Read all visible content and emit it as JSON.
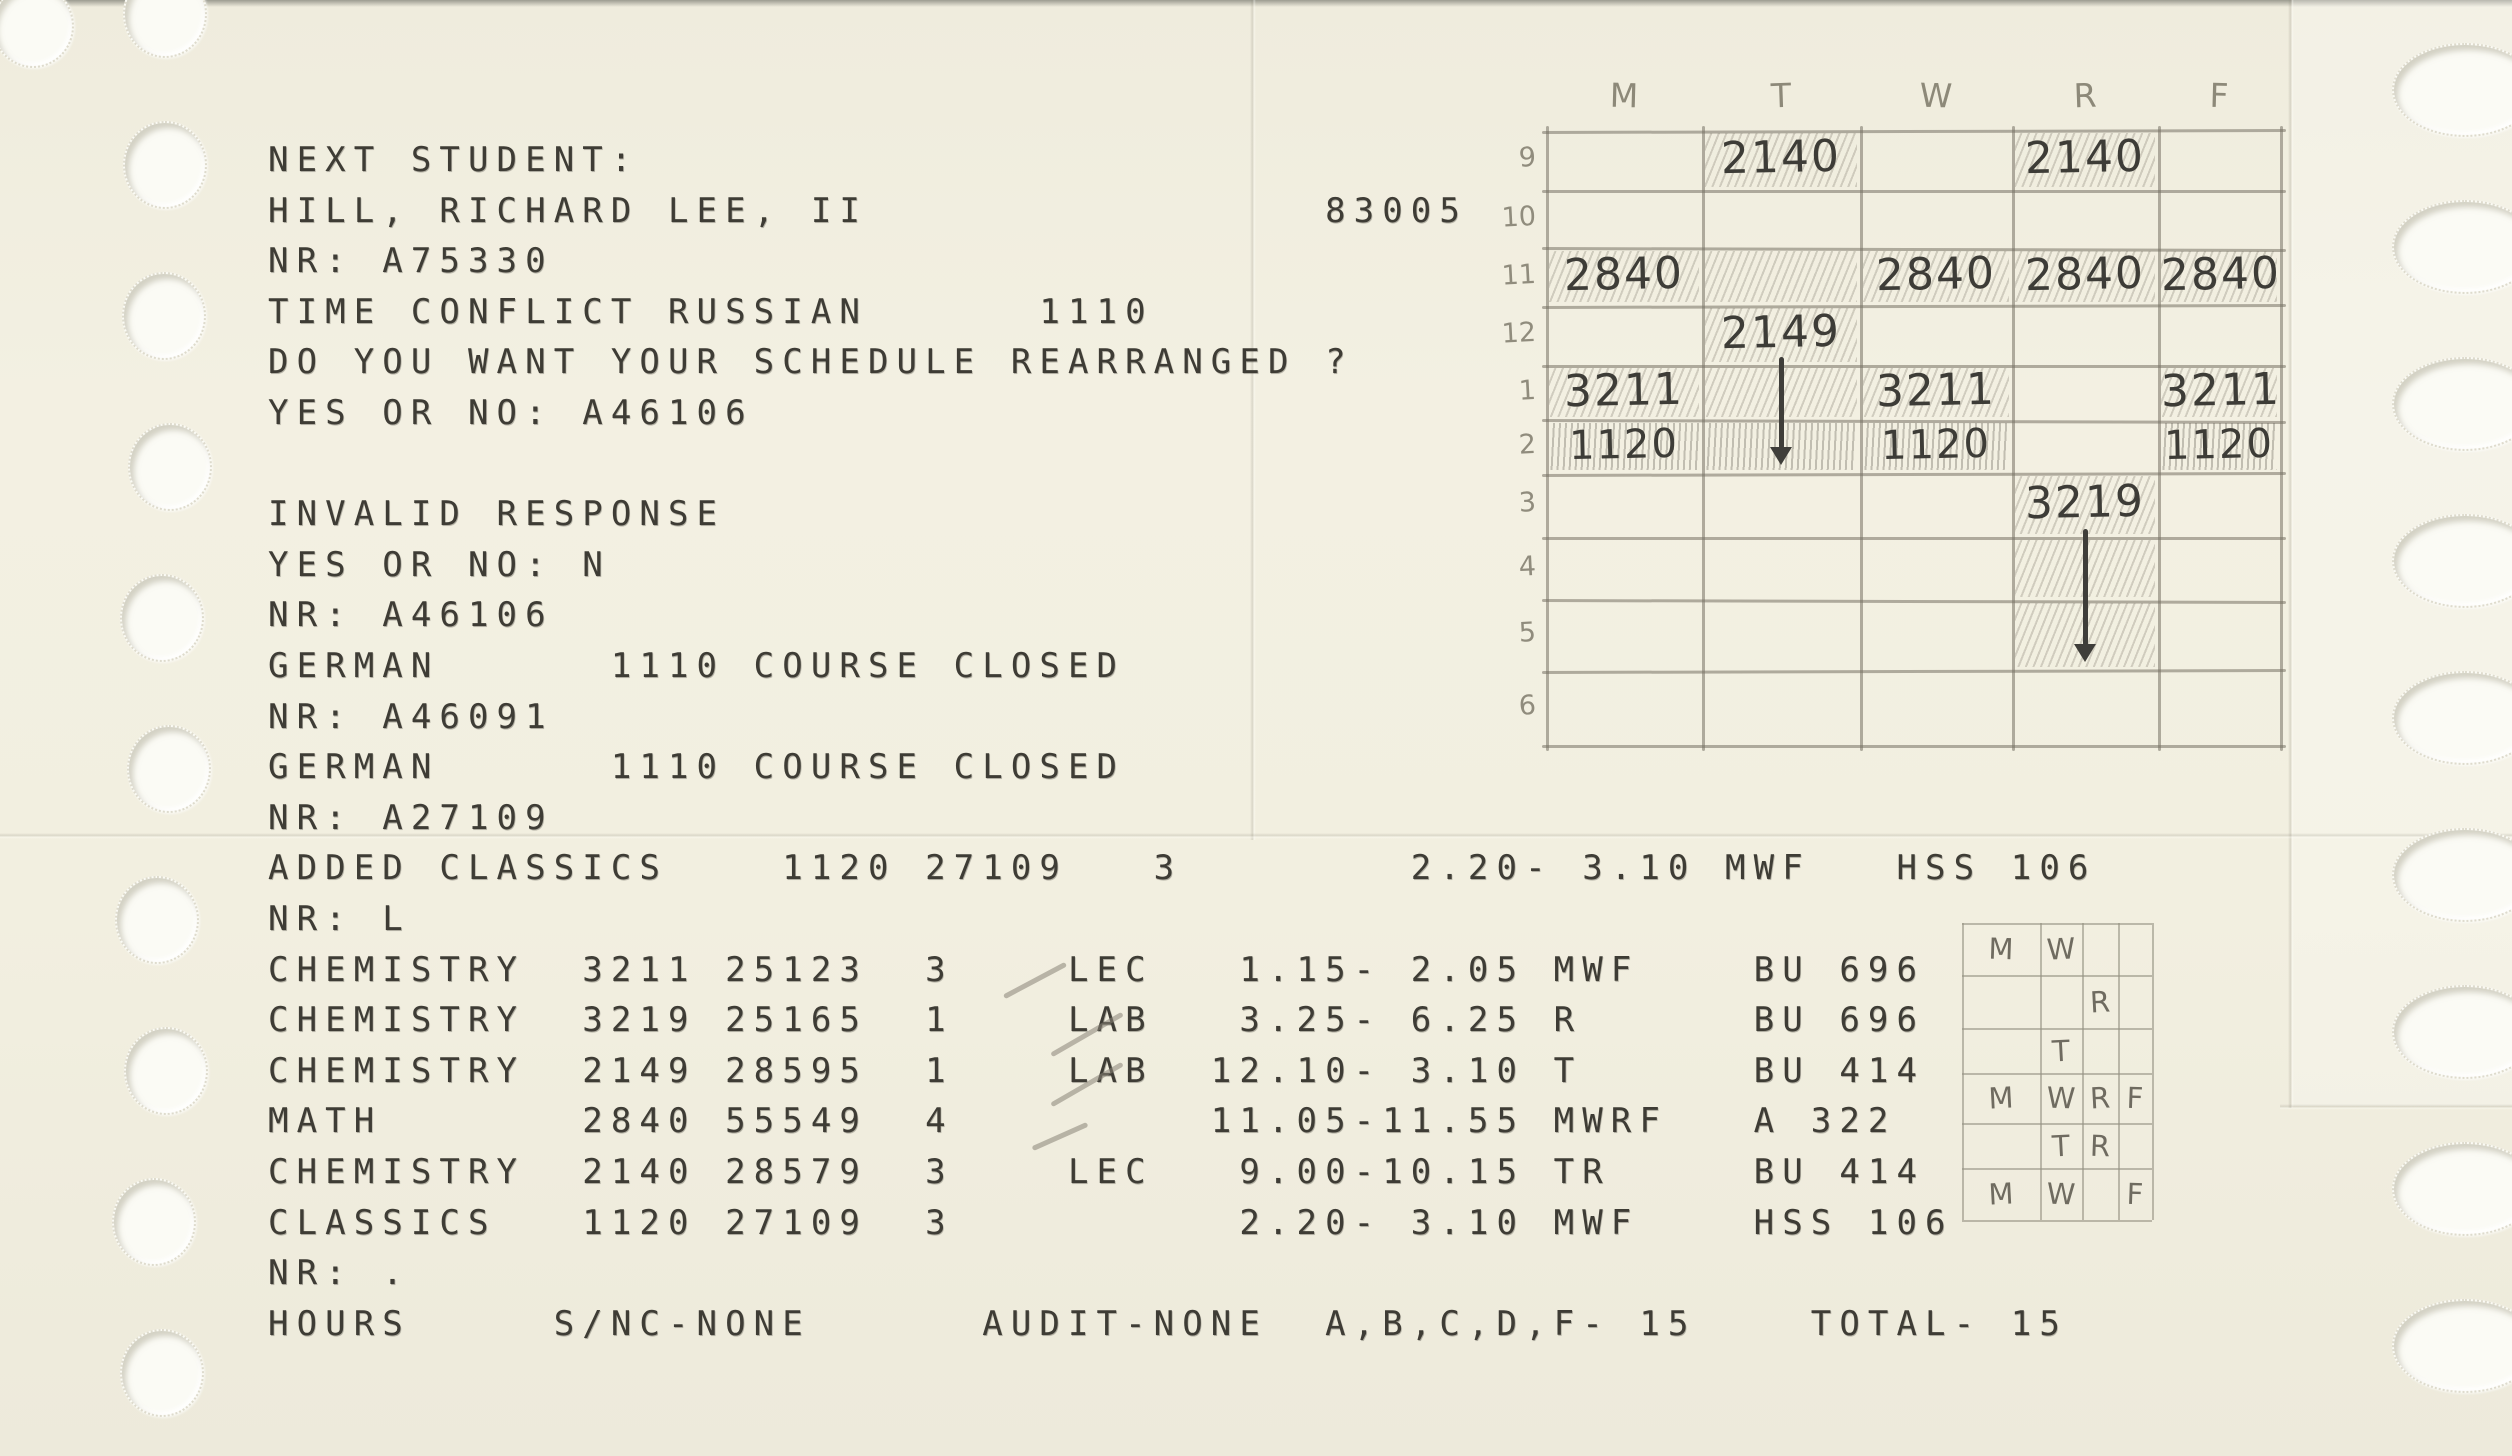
{
  "printout": {
    "lines": [
      "NEXT STUDENT:",
      "HILL, RICHARD LEE, II                83005",
      "NR: A75330",
      "TIME CONFLICT RUSSIAN      1110",
      "DO YOU WANT YOUR SCHEDULE REARRANGED ?",
      "YES OR NO: A46106",
      "",
      "INVALID RESPONSE",
      "YES OR NO: N",
      "NR: A46106",
      "GERMAN      1110 COURSE CLOSED",
      "NR: A46091",
      "GERMAN      1110 COURSE CLOSED",
      "NR: A27109",
      "ADDED CLASSICS    1120 27109   3        2.20- 3.10 MWF   HSS 106",
      "NR: L",
      "CHEMISTRY  3211 25123  3    LEC   1.15- 2.05 MWF    BU 696",
      "CHEMISTRY  3219 25165  1    LAB   3.25- 6.25 R      BU 696",
      "CHEMISTRY  2149 28595  1    LAB  12.10- 3.10 T      BU 414",
      "MATH       2840 55549  4         11.05-11.55 MWRF   A 322",
      "CHEMISTRY  2140 28579  3    LEC   9.00-10.15 TR     BU 414",
      "CLASSICS   1120 27109  3          2.20- 3.10 MWF    HSS 106",
      "NR: .",
      "HOURS     S/NC-NONE      AUDIT-NONE  A,B,C,D,F- 15    TOTAL- 15"
    ],
    "student_name": "HILL, RICHARD LEE, II",
    "student_nr_prompts": [
      "A75330",
      "A46106",
      "A46091",
      "A27109",
      "L",
      "."
    ],
    "terminal_number": "83005",
    "courses": [
      {
        "dept": "CHEMISTRY",
        "course": "3211",
        "section_nr": "25123",
        "credits": "3",
        "type": "LEC",
        "time": "1.15- 2.05",
        "days": "MWF",
        "room": "BU 696"
      },
      {
        "dept": "CHEMISTRY",
        "course": "3219",
        "section_nr": "25165",
        "credits": "1",
        "type": "LAB",
        "time": "3.25- 6.25",
        "days": "R",
        "room": "BU 696"
      },
      {
        "dept": "CHEMISTRY",
        "course": "2149",
        "section_nr": "28595",
        "credits": "1",
        "type": "LAB",
        "time": "12.10- 3.10",
        "days": "T",
        "room": "BU 414"
      },
      {
        "dept": "MATH",
        "course": "2840",
        "section_nr": "55549",
        "credits": "4",
        "type": "",
        "time": "11.05-11.55",
        "days": "MWRF",
        "room": "A 322"
      },
      {
        "dept": "CHEMISTRY",
        "course": "2140",
        "section_nr": "28579",
        "credits": "3",
        "type": "LEC",
        "time": "9.00-10.15",
        "days": "TR",
        "room": "BU 414"
      },
      {
        "dept": "CLASSICS",
        "course": "1120",
        "section_nr": "27109",
        "credits": "3",
        "type": "",
        "time": "2.20- 3.10",
        "days": "MWF",
        "room": "HSS 106"
      }
    ],
    "hours_summary": {
      "label": "HOURS",
      "s_nc": "S/NC-NONE",
      "audit": "AUDIT-NONE",
      "graded": "A,B,C,D,F- 15",
      "total": "TOTAL- 15"
    }
  },
  "weekly_grid": {
    "day_headers": [
      "M",
      "T",
      "W",
      "R",
      "F"
    ],
    "hour_labels": [
      "9",
      "10",
      "11",
      "12",
      "1",
      "2",
      "3",
      "4",
      "5",
      "6"
    ],
    "entries": [
      {
        "row": "9",
        "day": "T",
        "text": "2140",
        "shaded": true
      },
      {
        "row": "9",
        "day": "R",
        "text": "2140",
        "shaded": true
      },
      {
        "row": "11",
        "day": "M",
        "text": "2840",
        "shaded": true
      },
      {
        "row": "11",
        "day": "W",
        "text": "2840",
        "shaded": true
      },
      {
        "row": "11",
        "day": "R",
        "text": "2840",
        "shaded": true
      },
      {
        "row": "11",
        "day": "F",
        "text": "2840",
        "shaded": true
      },
      {
        "row": "12",
        "day": "T",
        "text": "2149",
        "shaded": true
      },
      {
        "row": "1",
        "day": "M",
        "text": "3211",
        "shaded": true
      },
      {
        "row": "1",
        "day": "W",
        "text": "3211",
        "shaded": true
      },
      {
        "row": "1",
        "day": "F",
        "text": "3211",
        "shaded": true
      },
      {
        "row": "2",
        "day": "M",
        "text": "1120",
        "shaded": true
      },
      {
        "row": "2",
        "day": "T",
        "text": "",
        "shaded": true
      },
      {
        "row": "2",
        "day": "W",
        "text": "1120",
        "shaded": true
      },
      {
        "row": "2",
        "day": "F",
        "text": "1120",
        "shaded": true
      },
      {
        "row": "3",
        "day": "R",
        "text": "3219",
        "shaded": true
      }
    ],
    "extra_shaded": [
      {
        "row": "11",
        "day": "T"
      },
      {
        "row": "1",
        "day": "T"
      },
      {
        "row": "4",
        "day": "R"
      },
      {
        "row": "5",
        "day": "R"
      }
    ],
    "arrows": [
      {
        "day": "T",
        "from_row": "12",
        "to_row": "2"
      },
      {
        "day": "R",
        "from_row": "3",
        "to_row": "5"
      }
    ]
  },
  "mini_grid": {
    "rows": [
      [
        "M",
        "W",
        "",
        ""
      ],
      [
        "",
        "",
        "R",
        ""
      ],
      [
        "",
        "T",
        "",
        ""
      ],
      [
        "M",
        "W",
        "R",
        "F"
      ],
      [
        "",
        "T",
        "R",
        ""
      ],
      [
        "M",
        "W",
        "",
        "F"
      ]
    ]
  },
  "colors": {
    "paper": "#f1eee0",
    "ink": "#3e3c35",
    "pencil_dark": "#3d3c37",
    "pencil_light": "#8e8a7c"
  }
}
